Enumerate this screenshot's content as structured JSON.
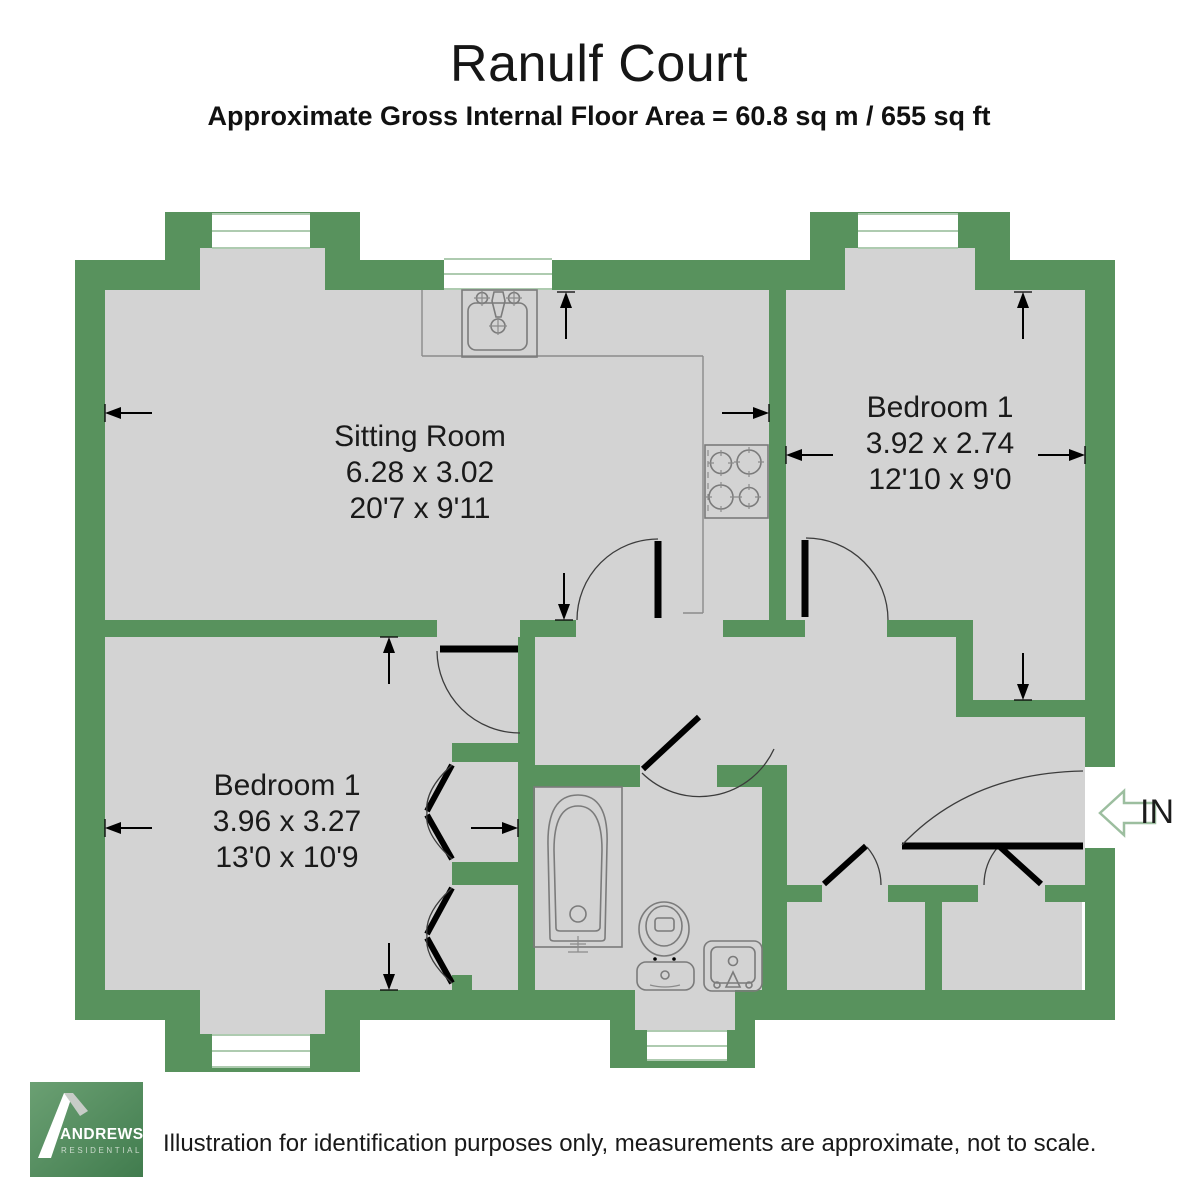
{
  "header": {
    "title": "Ranulf Court",
    "subtitle": "Approximate Gross Internal Floor Area = 60.8 sq m / 655 sq ft"
  },
  "plan": {
    "rooms": [
      {
        "name": "Sitting Room",
        "metric_dims": "6.28 x 3.02",
        "imperial_dims": "20'7 x 9'11"
      },
      {
        "name": "Bedroom 1",
        "metric_dims": "3.92 x 2.74",
        "imperial_dims": "12'10 x 9'0"
      },
      {
        "name": "Bedroom 1",
        "metric_dims": "3.96 x 3.27",
        "imperial_dims": "13'0 x 10'9"
      }
    ],
    "entrance_label": "IN",
    "fixtures": [
      "kitchen-sink-icon",
      "hob-icon",
      "bath-icon",
      "toilet-icon",
      "basin-icon",
      "wardrobe-bifold-icon"
    ],
    "colors": {
      "wall": "#58925D",
      "floor": "#D3D3D3",
      "window_frame": "#AECBB0",
      "in_arrow": "#9CBE9F"
    }
  },
  "footer": {
    "logo_name": "ANDREWS",
    "logo_sub": "RESIDENTIAL",
    "disclaimer": "Illustration for identification purposes only, measurements are approximate, not to scale."
  }
}
